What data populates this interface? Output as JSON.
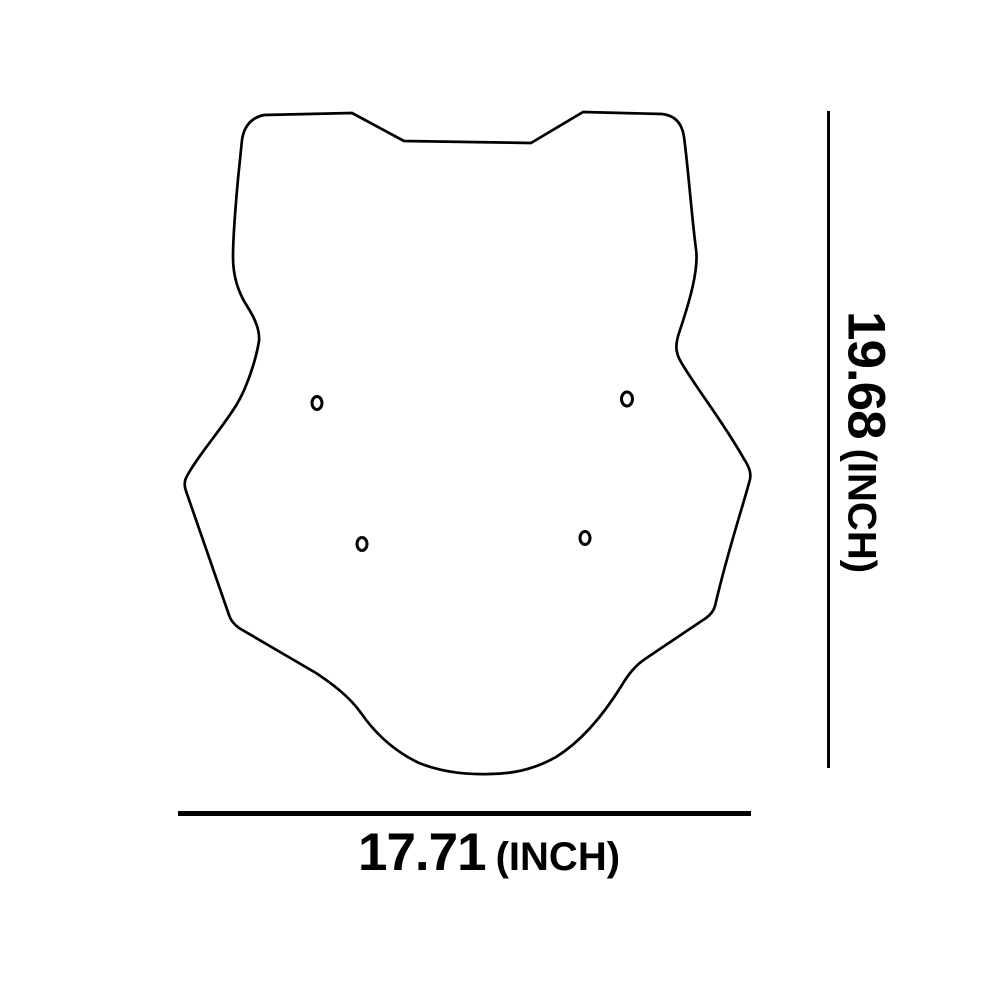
{
  "drawing": {
    "shape": "motorcycle-windscreen-outline",
    "stroke_color": "#000000",
    "background_color": "#ffffff",
    "mounting_hole_count": 4
  },
  "dimensions": {
    "height": {
      "value": "19.68",
      "unit": "(INCH)"
    },
    "width": {
      "value": "17.71",
      "unit": "(INCH)"
    }
  }
}
